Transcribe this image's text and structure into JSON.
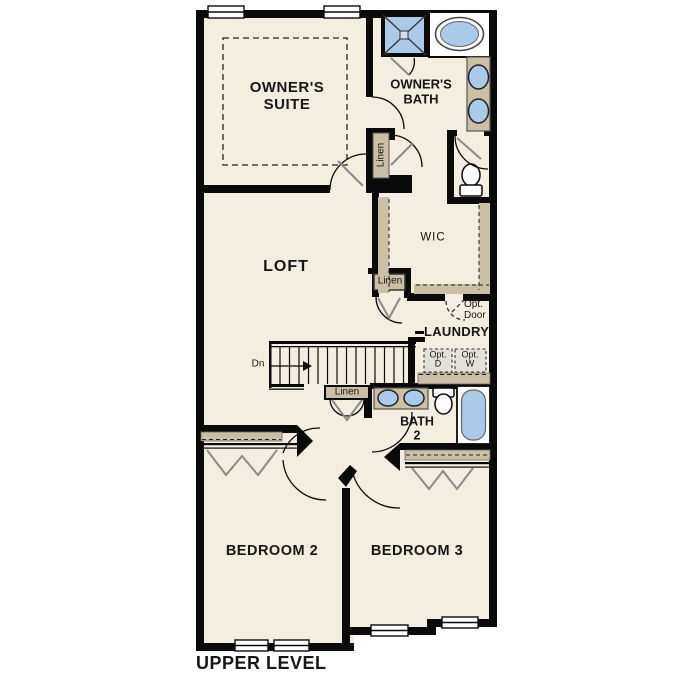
{
  "labels": {
    "owners_suite": "OWNER'S\nSUITE",
    "owners_bath": "OWNER'S\nBATH",
    "loft": "LOFT",
    "wic": "WIC",
    "laundry": "LAUNDRY",
    "bath2": "BATH\n2",
    "bedroom2": "BEDROOM 2",
    "bedroom3": "BEDROOM 3",
    "linen": "Linen",
    "opt_door": "Opt.\nDoor",
    "opt_d": "Opt.\nD",
    "opt_w": "Opt.\nW",
    "dn": "Dn",
    "title": "UPPER LEVEL"
  },
  "fixtures": {
    "owners_bath": [
      "shower-icon",
      "bathtub-icon",
      "double-sink-vanity-icon",
      "toilet-icon"
    ],
    "bath_2": [
      "double-sink-vanity-icon",
      "toilet-icon",
      "bathtub-icon"
    ],
    "laundry": [
      "optional-dryer-box",
      "optional-washer-box"
    ],
    "stairs_direction": "Dn",
    "closets": [
      "linen",
      "linen",
      "linen",
      "wic",
      "bedroom2-bifold-closet",
      "bedroom3-bifold-closet"
    ]
  },
  "colors": {
    "floor": "#f4eee1",
    "wall": "#0a0a0a",
    "fixture_blue": "#abc9e8",
    "cabinet_tan": "#cbc0a5",
    "optional_appliance_gray": "#e3e1db",
    "door_leaf_gray": "#8a8a8a"
  }
}
